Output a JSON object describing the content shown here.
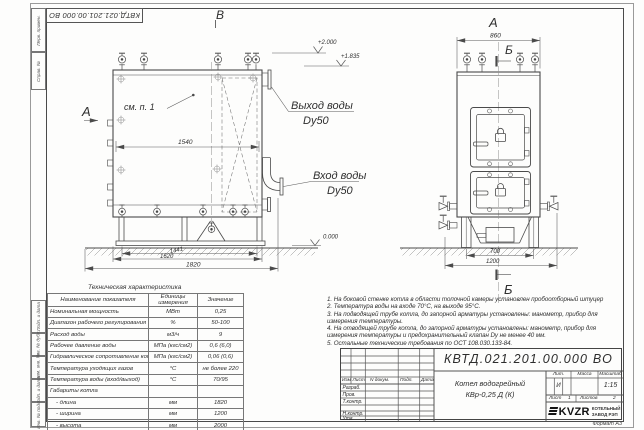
{
  "frame": {
    "stamp_number": "КВТД.021.201.00.000 ВО",
    "format_label": "Формат А3",
    "left_strip": [
      "Перв. примен.",
      "Справ. №",
      "Подп. и дата",
      "Инв. № дубл.",
      "Взам. инв. №",
      "Подп. и дата",
      "Инв. № подл."
    ]
  },
  "views": {
    "front": {
      "view_letter": "В",
      "arrow_letter": "А",
      "see_note": "см. п. 1",
      "elev_top": "+2.000",
      "elev_mid": "+1.835",
      "elev_zero": "0.000",
      "out_line1": "Выход воды",
      "out_line2": "Dy50",
      "in_line1": "Вход воды",
      "in_line2": "Dy50",
      "dim_inner": "1540",
      "dim_1441": "1441",
      "dim_1620": "1620",
      "dim_1820": "1820"
    },
    "side": {
      "view_letter": "А",
      "section_letter_top": "Б",
      "section_letter_bottom": "Б",
      "dim_width": "860",
      "dim_700": "700",
      "dim_1200": "1200"
    }
  },
  "tech_table": {
    "title": "Техническая характеристика",
    "headers": [
      "Наименование показателя",
      "Единицы измерения",
      "Значение"
    ],
    "rows": [
      [
        "Номинальная мощность",
        "МВт",
        "0,25"
      ],
      [
        "Диапазон рабочего регулирования",
        "%",
        "50-100"
      ],
      [
        "Расход воды",
        "м3/ч",
        "9"
      ],
      [
        "Рабочее давление воды",
        "МПа (кгс/см2)",
        "0,6 (6,0)"
      ],
      [
        "Гидравлическое сопротивление котла",
        "МПа (кгс/см2)",
        "0,06 (0,6)"
      ],
      [
        "Температура уходящих газов",
        "°С",
        "не более 220"
      ],
      [
        "Температура воды (вход/выход)",
        "°С",
        "70/95"
      ],
      [
        "Габариты котла",
        "",
        ""
      ],
      [
        "- длина",
        "мм",
        "1820"
      ],
      [
        "- ширина",
        "мм",
        "1200"
      ],
      [
        "- высота",
        "мм",
        "2000"
      ]
    ]
  },
  "notes": [
    "1.  На боковой стенке котла в области топочной камеры установлен пробоотборный штуцер",
    "2.  Температура воды на входе 70°С, на выходе 95°С.",
    "3.  На подводящей трубе котла, до запорной арматуры установлены: манометр, прибор для измерения температуры.",
    "4.  На отводящей трубе котла, до запорной арматуры установлены: манометр, прибор для измерения температуры и предохранительный клапан Dу не менее 40 мм.",
    "5.  Остальные технические требования по ОСТ 108.030.133-84."
  ],
  "title_block": {
    "doc_number": "КВТД.021.201.00.000 ВО",
    "name_line1": "Котел водогрейный",
    "name_line2": "КВр-0,25 Д (К)",
    "col_izm": "Изм",
    "col_list": "Лист",
    "col_ndoc": "N докум.",
    "col_podp": "Подп.",
    "col_data": "Дата",
    "roles": [
      "Разраб.",
      "Пров.",
      "Т.контр.",
      "",
      "Н.контр.",
      "Утв."
    ],
    "lit_label": "Лит.",
    "mass_label": "Масса",
    "scale_label": "Масштаб",
    "lit_value": "И",
    "scale_value": "1:15",
    "sheet_label": "Лист",
    "sheet_value": "1",
    "sheets_label": "Листов",
    "sheets_value": "2",
    "logo_text": "KVZR",
    "company_line1": "КОТЕЛЬНЫЙ",
    "company_line2": "ЗАВОД РЭП"
  }
}
